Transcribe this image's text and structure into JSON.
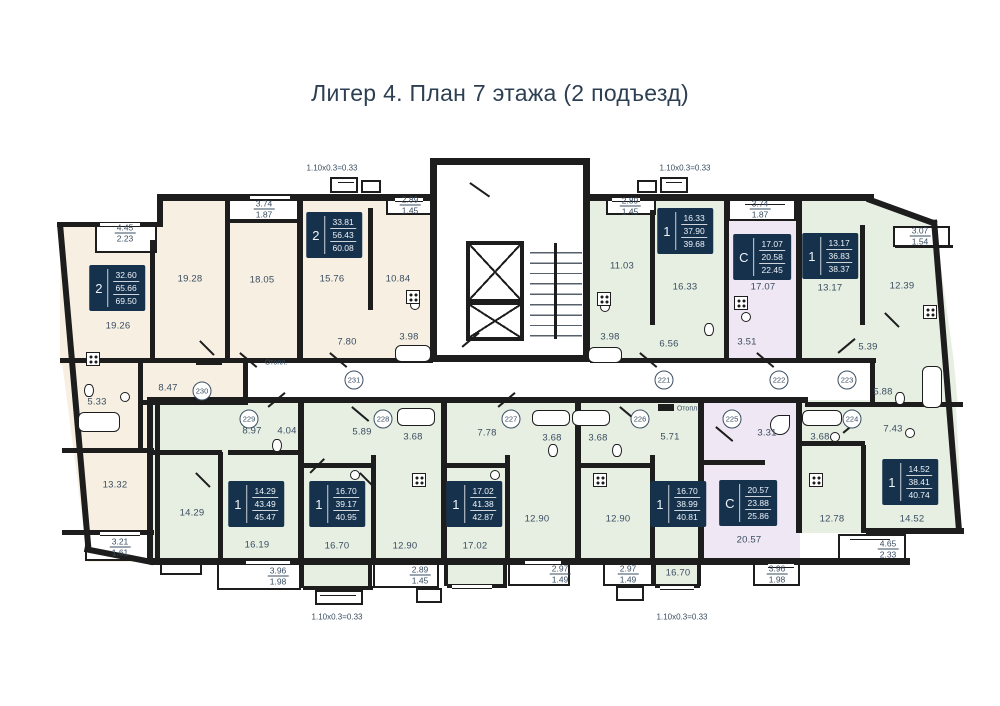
{
  "title": "Литер 4. План 7 этажа (2 подъезд)",
  "colors": {
    "cream": "#f7f0e2",
    "green": "#e7efe2",
    "purple": "#efe7f3",
    "white": "#ffffff",
    "wall": "#1d1d1d",
    "text": "#3a4d61",
    "info_bg": "#16314c",
    "info_text": "#edf4fa"
  },
  "room_labels": [
    {
      "x": 118,
      "y": 326,
      "text": "19.26"
    },
    {
      "x": 190,
      "y": 279,
      "text": "19.28"
    },
    {
      "x": 262,
      "y": 280,
      "text": "18.05"
    },
    {
      "x": 168,
      "y": 388,
      "text": "8.47"
    },
    {
      "x": 97,
      "y": 402,
      "text": "5.33"
    },
    {
      "x": 115,
      "y": 485,
      "text": "13.32"
    },
    {
      "x": 332,
      "y": 279,
      "text": "15.76"
    },
    {
      "x": 398,
      "y": 279,
      "text": "10.84"
    },
    {
      "x": 347,
      "y": 342,
      "text": "7.80"
    },
    {
      "x": 409,
      "y": 337,
      "text": "3.98"
    },
    {
      "x": 622,
      "y": 266,
      "text": "11.03"
    },
    {
      "x": 685,
      "y": 287,
      "text": "16.33"
    },
    {
      "x": 669,
      "y": 344,
      "text": "6.56"
    },
    {
      "x": 610,
      "y": 337,
      "text": "3.98"
    },
    {
      "x": 763,
      "y": 287,
      "text": "17.07"
    },
    {
      "x": 747,
      "y": 342,
      "text": "3.51"
    },
    {
      "x": 830,
      "y": 288,
      "text": "13.17"
    },
    {
      "x": 902,
      "y": 286,
      "text": "12.39"
    },
    {
      "x": 868,
      "y": 347,
      "text": "5.39"
    },
    {
      "x": 883,
      "y": 392,
      "text": "5.88"
    },
    {
      "x": 252,
      "y": 431,
      "text": "8.97"
    },
    {
      "x": 287,
      "y": 431,
      "text": "4.04"
    },
    {
      "x": 192,
      "y": 513,
      "text": "14.29"
    },
    {
      "x": 257,
      "y": 545,
      "text": "16.19"
    },
    {
      "x": 362,
      "y": 432,
      "text": "5.89"
    },
    {
      "x": 413,
      "y": 437,
      "text": "3.68"
    },
    {
      "x": 337,
      "y": 546,
      "text": "16.70"
    },
    {
      "x": 405,
      "y": 546,
      "text": "12.90"
    },
    {
      "x": 487,
      "y": 433,
      "text": "7.78"
    },
    {
      "x": 552,
      "y": 438,
      "text": "3.68"
    },
    {
      "x": 475,
      "y": 546,
      "text": "17.02"
    },
    {
      "x": 537,
      "y": 519,
      "text": "12.90"
    },
    {
      "x": 598,
      "y": 438,
      "text": "3.68"
    },
    {
      "x": 618,
      "y": 519,
      "text": "12.90"
    },
    {
      "x": 670,
      "y": 437,
      "text": "5.71"
    },
    {
      "x": 678,
      "y": 573,
      "text": "16.70"
    },
    {
      "x": 767,
      "y": 433,
      "text": "3.31"
    },
    {
      "x": 749,
      "y": 540,
      "text": "20.57"
    },
    {
      "x": 820,
      "y": 437,
      "text": "3.68"
    },
    {
      "x": 832,
      "y": 519,
      "text": "12.78"
    },
    {
      "x": 893,
      "y": 429,
      "text": "7.43"
    },
    {
      "x": 912,
      "y": 519,
      "text": "14.52"
    }
  ],
  "balcony_labels": [
    {
      "x": 125,
      "y": 233,
      "top": "4.45",
      "bottom": "2.23"
    },
    {
      "x": 264,
      "y": 209,
      "top": "3.74",
      "bottom": "1.87"
    },
    {
      "x": 410,
      "y": 205,
      "top": "2.89",
      "bottom": "1.45"
    },
    {
      "x": 630,
      "y": 206,
      "top": "2.89",
      "bottom": "1.45"
    },
    {
      "x": 760,
      "y": 209,
      "top": "3.74",
      "bottom": "1.87"
    },
    {
      "x": 920,
      "y": 236,
      "top": "3.07",
      "bottom": "1.54"
    },
    {
      "x": 120,
      "y": 547,
      "top": "3.21",
      "bottom": "1.61"
    },
    {
      "x": 278,
      "y": 576,
      "top": "3.96",
      "bottom": "1.98"
    },
    {
      "x": 420,
      "y": 575,
      "top": "2.89",
      "bottom": "1.45"
    },
    {
      "x": 560,
      "y": 574,
      "top": "2.97",
      "bottom": "1.49"
    },
    {
      "x": 628,
      "y": 574,
      "top": "2.97",
      "bottom": "1.49"
    },
    {
      "x": 777,
      "y": 574,
      "top": "3.96",
      "bottom": "1.98"
    },
    {
      "x": 888,
      "y": 549,
      "top": "4.65",
      "bottom": "2.33"
    }
  ],
  "info_boxes": [
    {
      "x": 117,
      "y": 288,
      "type": "2",
      "living": "32.60",
      "area": "65.66",
      "total": "69.50"
    },
    {
      "x": 334,
      "y": 235,
      "type": "2",
      "living": "33.81",
      "area": "56.43",
      "total": "60.08"
    },
    {
      "x": 685,
      "y": 231,
      "type": "1",
      "living": "16.33",
      "area": "37.90",
      "total": "39.68"
    },
    {
      "x": 762,
      "y": 257,
      "type": "С",
      "living": "17.07",
      "area": "20.58",
      "total": "22.45"
    },
    {
      "x": 830,
      "y": 256,
      "type": "1",
      "living": "13.17",
      "area": "36.83",
      "total": "38.37"
    },
    {
      "x": 256,
      "y": 504,
      "type": "1",
      "living": "14.29",
      "area": "43.49",
      "total": "45.47"
    },
    {
      "x": 337,
      "y": 504,
      "type": "1",
      "living": "16.70",
      "area": "39.17",
      "total": "40.95"
    },
    {
      "x": 474,
      "y": 504,
      "type": "1",
      "living": "17.02",
      "area": "41.38",
      "total": "42.87"
    },
    {
      "x": 678,
      "y": 504,
      "type": "1",
      "living": "16.70",
      "area": "38.99",
      "total": "40.81"
    },
    {
      "x": 748,
      "y": 503,
      "type": "С",
      "living": "20.57",
      "area": "23.88",
      "total": "25.86"
    },
    {
      "x": 910,
      "y": 482,
      "type": "1",
      "living": "14.52",
      "area": "38.41",
      "total": "40.74"
    }
  ],
  "unit_markers": [
    {
      "x": 202,
      "y": 391,
      "number": "230"
    },
    {
      "x": 354,
      "y": 380,
      "number": "231"
    },
    {
      "x": 664,
      "y": 380,
      "number": "221"
    },
    {
      "x": 779,
      "y": 380,
      "number": "222"
    },
    {
      "x": 847,
      "y": 380,
      "number": "223"
    },
    {
      "x": 249,
      "y": 419,
      "number": "229"
    },
    {
      "x": 383,
      "y": 419,
      "number": "228"
    },
    {
      "x": 511,
      "y": 419,
      "number": "227"
    },
    {
      "x": 640,
      "y": 419,
      "number": "226"
    },
    {
      "x": 732,
      "y": 419,
      "number": "225"
    },
    {
      "x": 852,
      "y": 419,
      "number": "224"
    }
  ],
  "dimension_labels": [
    {
      "x": 332,
      "y": 168,
      "text": "1.10x0.3=0.33"
    },
    {
      "x": 685,
      "y": 168,
      "text": "1.10x0.3=0.33"
    },
    {
      "x": 337,
      "y": 617,
      "text": "1.10x0.3=0.33"
    },
    {
      "x": 682,
      "y": 617,
      "text": "1.10x0.3=0.33"
    }
  ],
  "heating_labels": [
    {
      "x": 276,
      "y": 363,
      "text": "Отопл."
    },
    {
      "x": 688,
      "y": 409,
      "text": "Отопл."
    }
  ]
}
